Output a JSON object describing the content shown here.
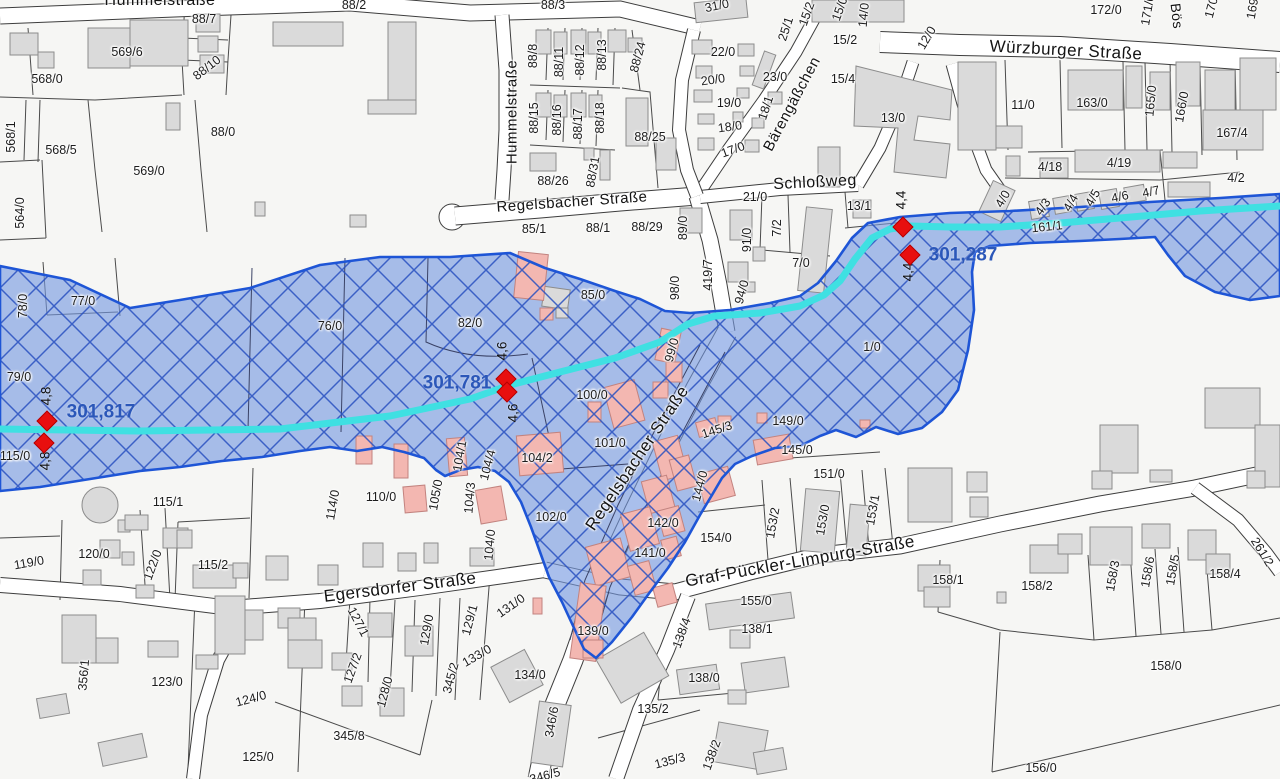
{
  "map_type": "flood-hazard cadastral map",
  "colors": {
    "flood_fill": "#7598e0",
    "flood_hatch": "#2850c0",
    "flood_border": "#1e55d6",
    "stream": "#3fe0e2",
    "building_grey": "#dadada",
    "building_pink": "#f3b7b1",
    "marker_red": "#e80f0f",
    "gauge_text_blue": "#2b57b9",
    "background": "#f6f6f4"
  },
  "gauges": [
    {
      "water_level": "301,817",
      "depth": "4,8"
    },
    {
      "water_level": "301,781",
      "depth": "4,6"
    },
    {
      "water_level": "301,287",
      "depth": "4,4"
    }
  ],
  "gauge_labels": [
    {
      "t": "301,817",
      "x": 101,
      "y": 412
    },
    {
      "t": "301,781",
      "x": 457,
      "y": 383
    },
    {
      "t": "301,287",
      "x": 963,
      "y": 255
    }
  ],
  "depth_labels": [
    {
      "t": "4,8",
      "x": 46,
      "y": 396
    },
    {
      "t": "4,8",
      "x": 45,
      "y": 461
    },
    {
      "t": "4,6",
      "x": 502,
      "y": 351
    },
    {
      "t": "4,6",
      "x": 513,
      "y": 413
    },
    {
      "t": "4,4",
      "x": 901,
      "y": 200
    },
    {
      "t": "4,4",
      "x": 908,
      "y": 272
    }
  ],
  "markers": [
    {
      "x": 47,
      "y": 421
    },
    {
      "x": 44,
      "y": 443
    },
    {
      "x": 506,
      "y": 379
    },
    {
      "x": 507,
      "y": 392
    },
    {
      "x": 903,
      "y": 227
    },
    {
      "x": 910,
      "y": 255
    }
  ],
  "street_labels": [
    {
      "t": "Hummelstraße",
      "x": 160,
      "y": 1,
      "r": 0,
      "s": 16
    },
    {
      "t": "Hummelstraße",
      "x": 512,
      "y": 112,
      "r": -90,
      "s": 15
    },
    {
      "t": "Regelsbacher Straße",
      "x": 572,
      "y": 202,
      "r": -4,
      "s": 15
    },
    {
      "t": "Regelsbacher Straße",
      "x": 637,
      "y": 458,
      "r": -56,
      "s": 17
    },
    {
      "t": "Bärengäßchen",
      "x": 792,
      "y": 104,
      "r": -62,
      "s": 15
    },
    {
      "t": "Schloßweg",
      "x": 815,
      "y": 183,
      "r": -3,
      "s": 16
    },
    {
      "t": "Würzburger Straße",
      "x": 1066,
      "y": 50,
      "r": 3,
      "s": 17
    },
    {
      "t": "Bös",
      "x": 1177,
      "y": 16,
      "r": 83,
      "s": 14
    },
    {
      "t": "Egersdorfer Straße",
      "x": 400,
      "y": 587,
      "r": -7,
      "s": 17
    },
    {
      "t": "Graf-Pückler-Limpurg-Straße",
      "x": 800,
      "y": 561,
      "r": -10,
      "s": 17
    }
  ],
  "parcel_labels": [
    {
      "t": "88/7",
      "x": 204,
      "y": 19
    },
    {
      "t": "569/6",
      "x": 127,
      "y": 52
    },
    {
      "t": "88/10",
      "x": 207,
      "y": 68,
      "r": -38
    },
    {
      "t": "568/0",
      "x": 47,
      "y": 79
    },
    {
      "t": "88/2",
      "x": 354,
      "y": 5
    },
    {
      "t": "88/3",
      "x": 553,
      "y": 5
    },
    {
      "t": "568/1",
      "x": 11,
      "y": 137,
      "r": -90
    },
    {
      "t": "568/5",
      "x": 61,
      "y": 150
    },
    {
      "t": "569/0",
      "x": 149,
      "y": 171
    },
    {
      "t": "88/0",
      "x": 223,
      "y": 132
    },
    {
      "t": "564/0",
      "x": 20,
      "y": 213,
      "r": -90
    },
    {
      "t": "88/8",
      "x": 533,
      "y": 56,
      "r": -90
    },
    {
      "t": "88/11",
      "x": 559,
      "y": 62,
      "r": -90
    },
    {
      "t": "88/12",
      "x": 580,
      "y": 60,
      "r": -90
    },
    {
      "t": "88/13",
      "x": 602,
      "y": 55,
      "r": -90
    },
    {
      "t": "88/24",
      "x": 638,
      "y": 57,
      "r": -75
    },
    {
      "t": "88/15",
      "x": 534,
      "y": 118,
      "r": -90
    },
    {
      "t": "88/16",
      "x": 557,
      "y": 120,
      "r": -90
    },
    {
      "t": "88/17",
      "x": 578,
      "y": 124,
      "r": -90
    },
    {
      "t": "88/18",
      "x": 600,
      "y": 118,
      "r": -90
    },
    {
      "t": "88/25",
      "x": 650,
      "y": 137
    },
    {
      "t": "88/26",
      "x": 553,
      "y": 181
    },
    {
      "t": "88/31",
      "x": 593,
      "y": 172,
      "r": -80
    },
    {
      "t": "85/1",
      "x": 534,
      "y": 229
    },
    {
      "t": "88/1",
      "x": 598,
      "y": 228
    },
    {
      "t": "88/29",
      "x": 647,
      "y": 227
    },
    {
      "t": "89/0",
      "x": 683,
      "y": 228,
      "r": -90
    },
    {
      "t": "91/0",
      "x": 747,
      "y": 240,
      "r": -90
    },
    {
      "t": "7/2",
      "x": 777,
      "y": 228,
      "r": -90
    },
    {
      "t": "7/0",
      "x": 801,
      "y": 263
    },
    {
      "t": "419/7",
      "x": 708,
      "y": 275,
      "r": -90
    },
    {
      "t": "94/0",
      "x": 742,
      "y": 292,
      "r": -75
    },
    {
      "t": "98/0",
      "x": 675,
      "y": 288,
      "r": -90
    },
    {
      "t": "31/0",
      "x": 717,
      "y": 6,
      "r": -12
    },
    {
      "t": "22/0",
      "x": 723,
      "y": 52
    },
    {
      "t": "20/0",
      "x": 713,
      "y": 80,
      "r": -8
    },
    {
      "t": "19/0",
      "x": 729,
      "y": 103
    },
    {
      "t": "18/0",
      "x": 730,
      "y": 127,
      "r": -8
    },
    {
      "t": "17/0",
      "x": 733,
      "y": 150,
      "r": -20
    },
    {
      "t": "23/0",
      "x": 775,
      "y": 77
    },
    {
      "t": "18/1",
      "x": 766,
      "y": 108,
      "r": -72
    },
    {
      "t": "25/1",
      "x": 786,
      "y": 29,
      "r": -72
    },
    {
      "t": "15/2",
      "x": 807,
      "y": 14,
      "r": -70
    },
    {
      "t": "15/0",
      "x": 840,
      "y": 9,
      "r": -70
    },
    {
      "t": "14/0",
      "x": 864,
      "y": 15,
      "r": -85
    },
    {
      "t": "15/2",
      "x": 845,
      "y": 40
    },
    {
      "t": "15/4",
      "x": 843,
      "y": 79
    },
    {
      "t": "12/0",
      "x": 927,
      "y": 38,
      "r": -60
    },
    {
      "t": "13/0",
      "x": 893,
      "y": 118
    },
    {
      "t": "21/0",
      "x": 755,
      "y": 197
    },
    {
      "t": "13/1",
      "x": 859,
      "y": 206
    },
    {
      "t": "172/0",
      "x": 1106,
      "y": 10
    },
    {
      "t": "171/0",
      "x": 1148,
      "y": 10,
      "r": -80
    },
    {
      "t": "170/",
      "x": 1212,
      "y": 6,
      "r": -75
    },
    {
      "t": "169/",
      "x": 1253,
      "y": 7,
      "r": -80
    },
    {
      "t": "11/0",
      "x": 1023,
      "y": 105
    },
    {
      "t": "163/0",
      "x": 1092,
      "y": 103
    },
    {
      "t": "165/0",
      "x": 1151,
      "y": 101,
      "r": -85
    },
    {
      "t": "166/0",
      "x": 1182,
      "y": 107,
      "r": -80
    },
    {
      "t": "167/4",
      "x": 1232,
      "y": 133
    },
    {
      "t": "4/18",
      "x": 1050,
      "y": 167
    },
    {
      "t": "4/19",
      "x": 1119,
      "y": 163
    },
    {
      "t": "4/2",
      "x": 1236,
      "y": 178
    },
    {
      "t": "4/0",
      "x": 1003,
      "y": 199,
      "r": -60
    },
    {
      "t": "4/3",
      "x": 1043,
      "y": 207,
      "r": -55
    },
    {
      "t": "4/4",
      "x": 1071,
      "y": 203,
      "r": -60
    },
    {
      "t": "4/5",
      "x": 1093,
      "y": 198,
      "r": -60
    },
    {
      "t": "4/6",
      "x": 1120,
      "y": 197,
      "r": -12
    },
    {
      "t": "4/7",
      "x": 1151,
      "y": 192,
      "r": -12
    },
    {
      "t": "161/1",
      "x": 1047,
      "y": 227,
      "r": -6
    },
    {
      "t": "77/0",
      "x": 83,
      "y": 301
    },
    {
      "t": "78/0",
      "x": 23,
      "y": 306,
      "r": -90
    },
    {
      "t": "76/0",
      "x": 330,
      "y": 326
    },
    {
      "t": "82/0",
      "x": 470,
      "y": 323
    },
    {
      "t": "85/0",
      "x": 593,
      "y": 295
    },
    {
      "t": "79/0",
      "x": 19,
      "y": 377
    },
    {
      "t": "115/0",
      "x": 15,
      "y": 456
    },
    {
      "t": "99/0",
      "x": 672,
      "y": 350,
      "r": -75
    },
    {
      "t": "100/0",
      "x": 592,
      "y": 395
    },
    {
      "t": "101/0",
      "x": 610,
      "y": 443
    },
    {
      "t": "1/0",
      "x": 872,
      "y": 347
    },
    {
      "t": "104/2",
      "x": 537,
      "y": 458
    },
    {
      "t": "104/1",
      "x": 460,
      "y": 456,
      "r": -80
    },
    {
      "t": "104/4",
      "x": 488,
      "y": 465,
      "r": -75
    },
    {
      "t": "105/0",
      "x": 436,
      "y": 495,
      "r": -80
    },
    {
      "t": "104/3",
      "x": 470,
      "y": 498,
      "r": -85
    },
    {
      "t": "104/0",
      "x": 490,
      "y": 545,
      "r": -85
    },
    {
      "t": "102/0",
      "x": 551,
      "y": 517
    },
    {
      "t": "110/0",
      "x": 381,
      "y": 497
    },
    {
      "t": "114/0",
      "x": 333,
      "y": 505,
      "r": -80
    },
    {
      "t": "115/1",
      "x": 168,
      "y": 502
    },
    {
      "t": "115/2",
      "x": 213,
      "y": 565
    },
    {
      "t": "120/0",
      "x": 94,
      "y": 554
    },
    {
      "t": "119/0",
      "x": 29,
      "y": 563,
      "r": -10
    },
    {
      "t": "122/0",
      "x": 153,
      "y": 565,
      "r": -70
    },
    {
      "t": "356/1",
      "x": 84,
      "y": 675,
      "r": -85
    },
    {
      "t": "123/0",
      "x": 167,
      "y": 682
    },
    {
      "t": "124/0",
      "x": 251,
      "y": 699,
      "r": -15
    },
    {
      "t": "125/0",
      "x": 258,
      "y": 757
    },
    {
      "t": "345/8",
      "x": 349,
      "y": 736
    },
    {
      "t": "127/1",
      "x": 358,
      "y": 622,
      "r": 62
    },
    {
      "t": "127/2",
      "x": 353,
      "y": 668,
      "r": -70
    },
    {
      "t": "128/0",
      "x": 385,
      "y": 692,
      "r": -75
    },
    {
      "t": "129/0",
      "x": 427,
      "y": 630,
      "r": -80
    },
    {
      "t": "129/1",
      "x": 470,
      "y": 620,
      "r": -75
    },
    {
      "t": "131/0",
      "x": 511,
      "y": 606,
      "r": -35
    },
    {
      "t": "133/0",
      "x": 477,
      "y": 656,
      "r": -30
    },
    {
      "t": "345/2",
      "x": 451,
      "y": 678,
      "r": -75
    },
    {
      "t": "134/0",
      "x": 530,
      "y": 675
    },
    {
      "t": "346/6",
      "x": 552,
      "y": 722,
      "r": -80
    },
    {
      "t": "346/5",
      "x": 545,
      "y": 776,
      "r": -15
    },
    {
      "t": "139/0",
      "x": 593,
      "y": 631
    },
    {
      "t": "138/4",
      "x": 682,
      "y": 633,
      "r": -70
    },
    {
      "t": "138/1",
      "x": 757,
      "y": 629
    },
    {
      "t": "138/0",
      "x": 704,
      "y": 678
    },
    {
      "t": "135/2",
      "x": 653,
      "y": 709
    },
    {
      "t": "135/3",
      "x": 670,
      "y": 761,
      "r": -15
    },
    {
      "t": "138/2",
      "x": 712,
      "y": 755,
      "r": -70
    },
    {
      "t": "142/0",
      "x": 663,
      "y": 523
    },
    {
      "t": "141/0",
      "x": 650,
      "y": 553
    },
    {
      "t": "144/0",
      "x": 700,
      "y": 486,
      "r": -75
    },
    {
      "t": "145/3",
      "x": 717,
      "y": 430,
      "r": -18
    },
    {
      "t": "145/0",
      "x": 797,
      "y": 450
    },
    {
      "t": "149/0",
      "x": 788,
      "y": 421
    },
    {
      "t": "151/0",
      "x": 829,
      "y": 474
    },
    {
      "t": "154/0",
      "x": 716,
      "y": 538
    },
    {
      "t": "153/2",
      "x": 773,
      "y": 523,
      "r": -80
    },
    {
      "t": "153/0",
      "x": 823,
      "y": 520,
      "r": -80
    },
    {
      "t": "153/1",
      "x": 873,
      "y": 510,
      "r": -80
    },
    {
      "t": "155/0",
      "x": 756,
      "y": 601
    },
    {
      "t": "158/1",
      "x": 948,
      "y": 580
    },
    {
      "t": "158/2",
      "x": 1037,
      "y": 586
    },
    {
      "t": "158/3",
      "x": 1113,
      "y": 576,
      "r": -80
    },
    {
      "t": "158/6",
      "x": 1148,
      "y": 572,
      "r": -80
    },
    {
      "t": "158/5",
      "x": 1173,
      "y": 570,
      "r": -80
    },
    {
      "t": "158/4",
      "x": 1225,
      "y": 574
    },
    {
      "t": "158/0",
      "x": 1166,
      "y": 666
    },
    {
      "t": "156/0",
      "x": 1041,
      "y": 768
    },
    {
      "t": "261/2",
      "x": 1262,
      "y": 552,
      "r": 58
    }
  ]
}
